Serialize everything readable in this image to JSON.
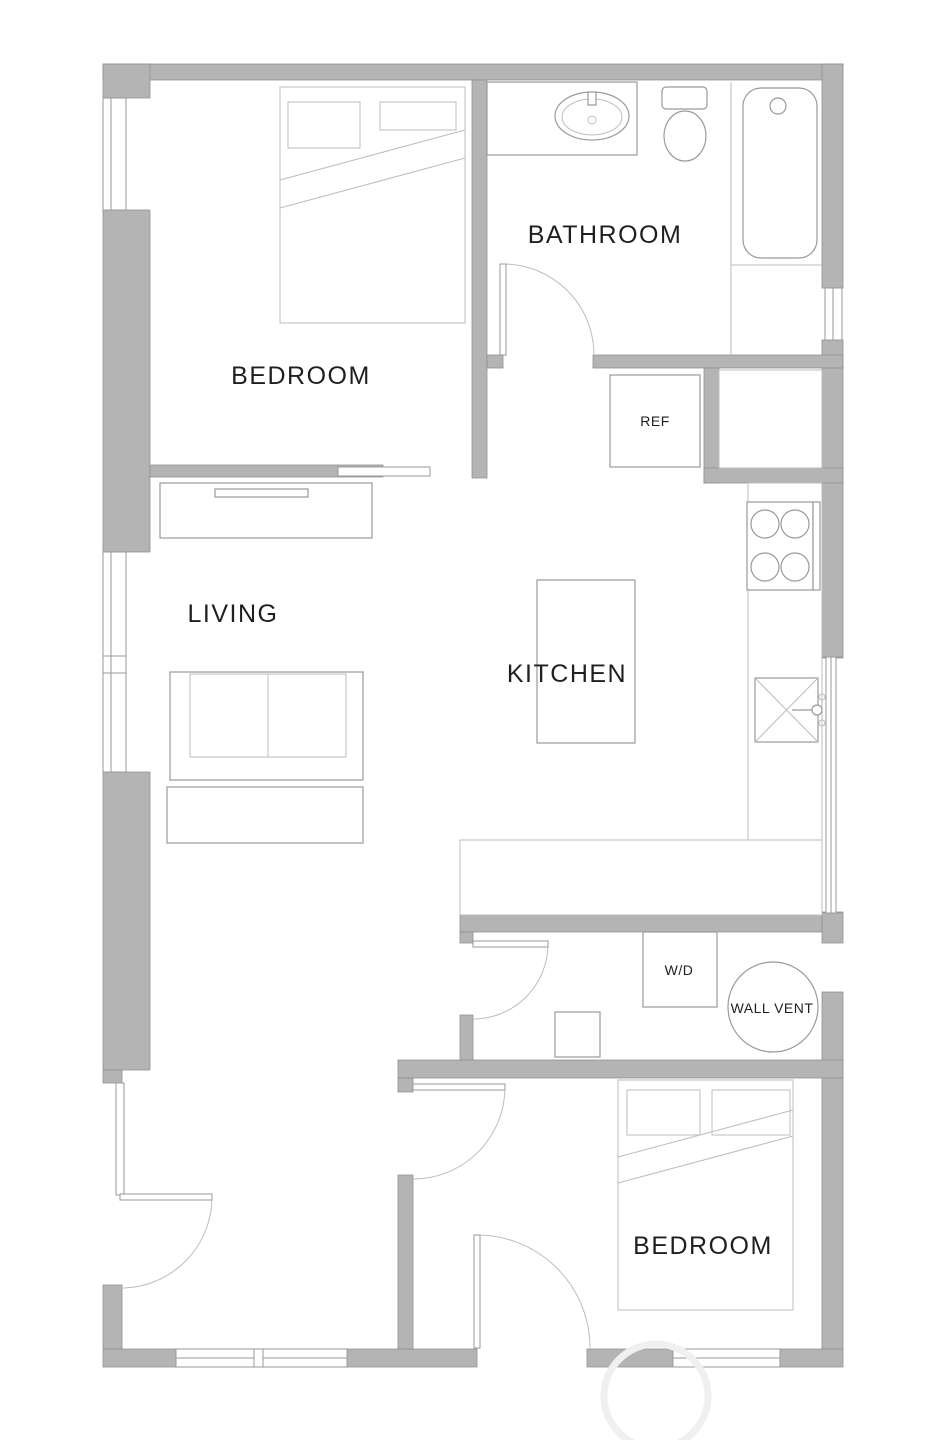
{
  "rooms": {
    "bedroom_top": {
      "label": "BEDROOM"
    },
    "bathroom": {
      "label": "BATHROOM"
    },
    "living": {
      "label": "LIVING"
    },
    "kitchen": {
      "label": "KITCHEN"
    },
    "bedroom_bottom": {
      "label": "BEDROOM"
    }
  },
  "fixtures": {
    "refrigerator": {
      "label": "REF"
    },
    "washer_dryer": {
      "label": "W/D"
    },
    "wall_vent": {
      "label": "WALL VENT"
    }
  },
  "colors": {
    "background": "#ffffff",
    "wall": "#b4b4b4",
    "wall_stroke": "#8e8e8e",
    "line": "#9a9a9a",
    "line_light": "#bdbdbd",
    "text": "#1f1f1f",
    "watermark": "#f0f0f0"
  }
}
